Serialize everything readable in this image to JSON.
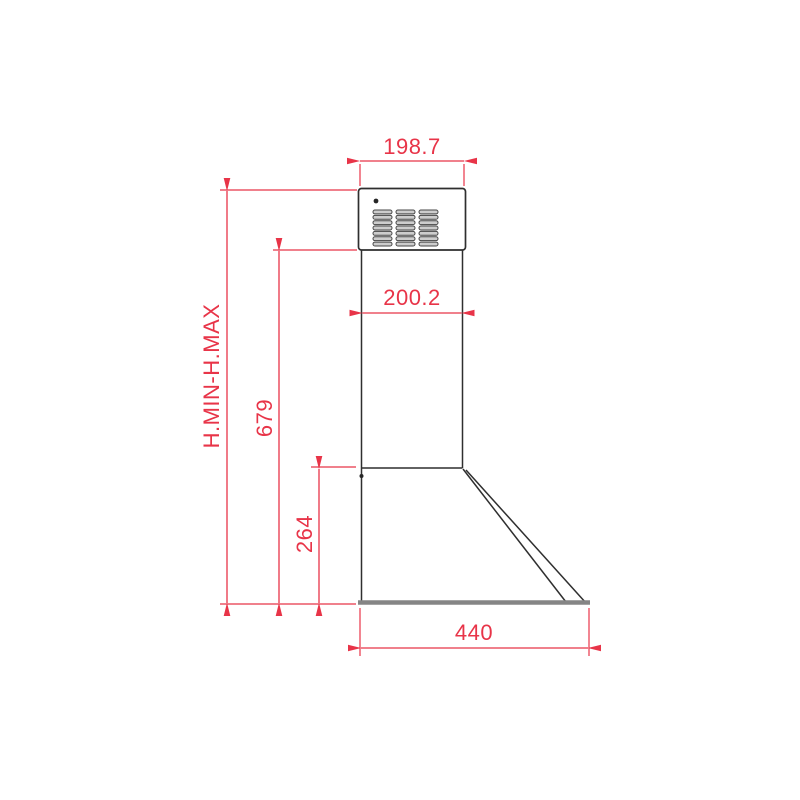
{
  "colors": {
    "accent": "#e83448",
    "ink": "#2f2f2f",
    "steel": "#858585",
    "vent_fill": "#cdcdcd",
    "vent_stroke": "#474747",
    "background": "#ffffff"
  },
  "drawing": {
    "dimensions": {
      "top_duct_width": "198.7",
      "chimney_width": "200.2",
      "height_range_label": "H.MIN-H.MAX",
      "chimney_height": "679",
      "canopy_height": "264",
      "base_depth": "440"
    },
    "vent_grid": {
      "rows": 7,
      "columns": 3
    }
  }
}
